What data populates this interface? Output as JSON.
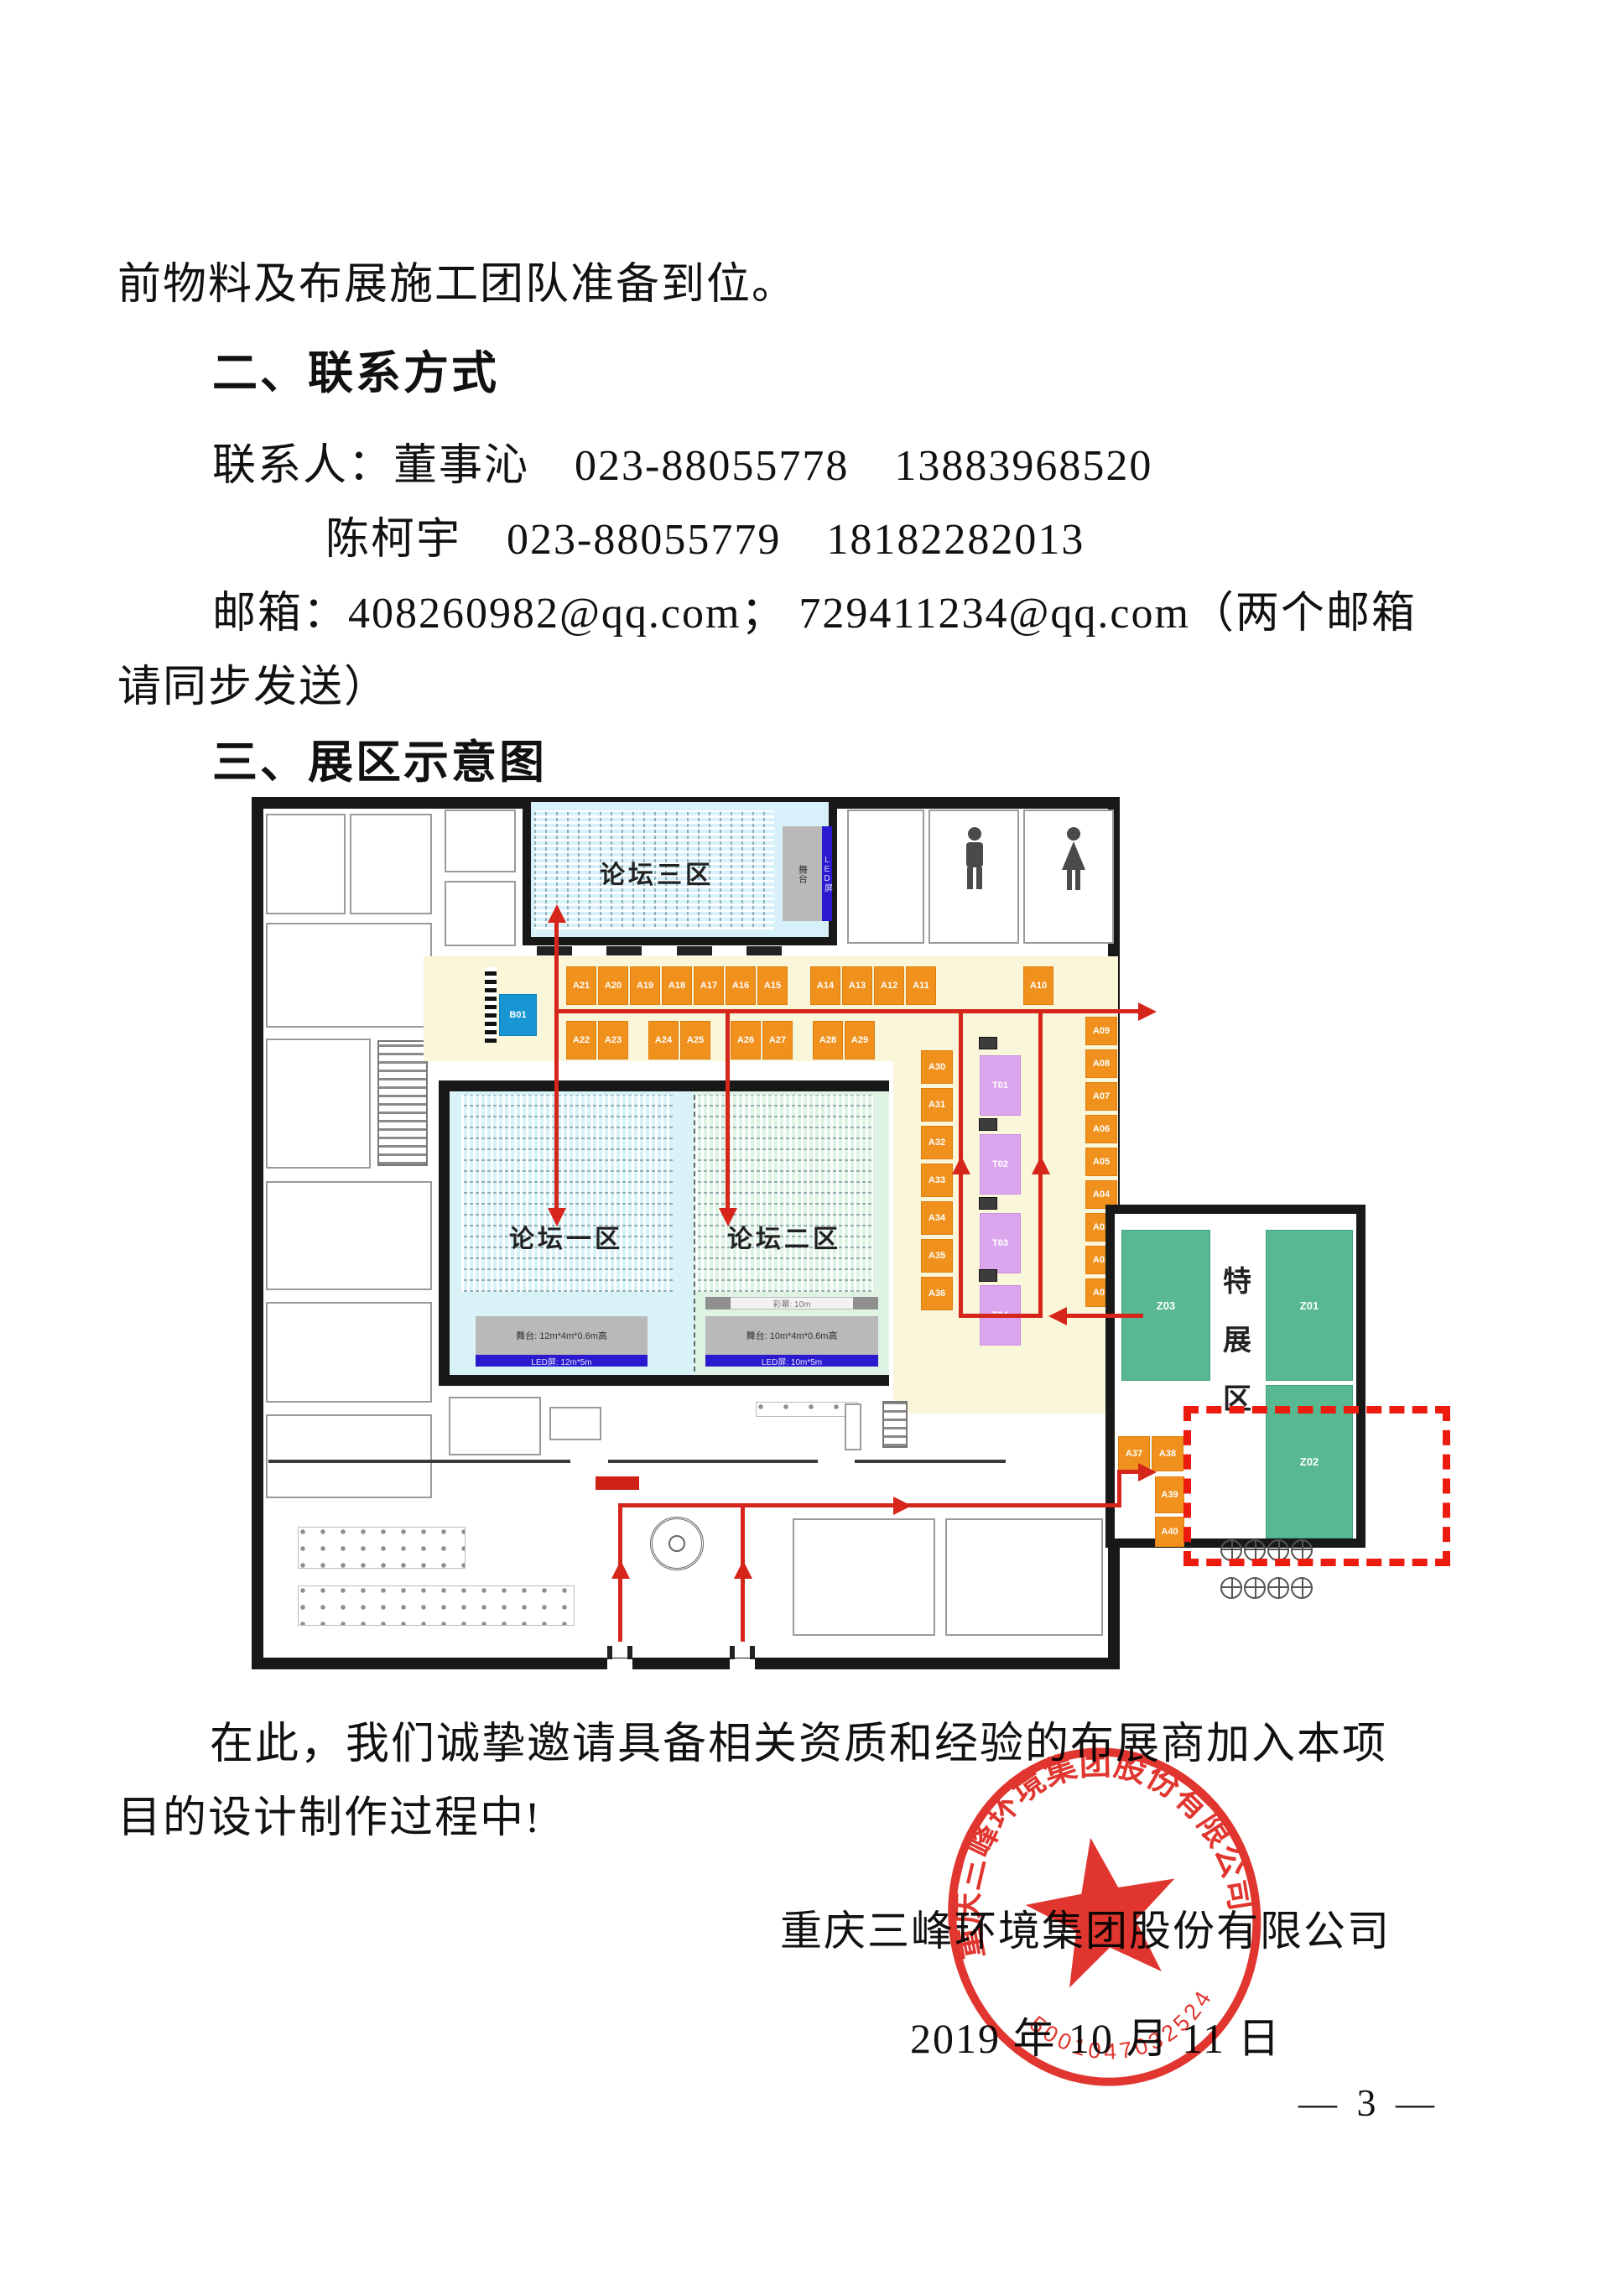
{
  "page": {
    "para_continuation": "前物料及布展施工团队准备到位。",
    "heading_contact": "二、联系方式",
    "contact_line1": "联系人：董事沁　023-88055778　13883968520",
    "contact_line2": "陈柯宇　023-88055779　18182282013",
    "email_line1": "邮箱：408260982@qq.com；  729411234@qq.com（两个邮箱",
    "email_line2": "请同步发送）",
    "heading_map": "三、展区示意图",
    "closing_line1": "在此，我们诚挚邀请具备相关资质和经验的布展商加入本项",
    "closing_line2": "目的设计制作过程中!"
  },
  "plan": {
    "rooms": {
      "forum1": "论坛一区",
      "forum2": "论坛二区",
      "forum3": "论坛三区",
      "special_zone": "特展区",
      "special_zone_chars": {
        "c1": "特",
        "c2": "展",
        "c3": "区"
      }
    },
    "booths": {
      "b01": "B01",
      "row1": [
        "A21",
        "A20",
        "A19",
        "A18",
        "A17",
        "A16",
        "A15",
        "A14",
        "A13",
        "A12",
        "A11",
        "A10"
      ],
      "row2": [
        "A22",
        "A23",
        "A24",
        "A25",
        "A26",
        "A27",
        "A28",
        "A29"
      ],
      "col_left": [
        "A30",
        "A31",
        "A32",
        "A33",
        "A34",
        "A35",
        "A36"
      ],
      "col_right": [
        "A09",
        "A08",
        "A07",
        "A06",
        "A05",
        "A04",
        "A03",
        "A02",
        "A01"
      ],
      "t_col": [
        "T01",
        "T02",
        "T03",
        "T04"
      ],
      "wing": [
        "A37",
        "A38",
        "A39",
        "A40"
      ],
      "z": [
        "Z03",
        "Z01",
        "Z02"
      ]
    },
    "stages": {
      "stage1": "舞台: 12m*4m*0.6m高",
      "led1": "LED屏: 12m*5m",
      "stage2": "舞台: 10m*4m*0.6m高",
      "led2": "LED屏: 10m*5m",
      "screen2": "彩幕: 10m",
      "stage3": "舞台",
      "led3": "LED屏"
    }
  },
  "icons": {
    "male_restroom": "male-restroom-icon",
    "female_restroom": "female-restroom-icon"
  },
  "footer": {
    "company": "重庆三峰环境集团股份有限公司",
    "date": "2019 年 10 月 11 日",
    "page_no": "— 3 —"
  },
  "seal": {
    "ring_text": "重庆三峰环境集团股份有限公司",
    "number": "5001047032524"
  },
  "colors": {
    "booth_orange": "#f0911d",
    "booth_purple": "#dba6ee",
    "booth_blue": "#1796d3",
    "booth_green": "#58b892",
    "room_cyan": "#d7f0fa",
    "room_green": "#def3e3",
    "corridor_cream": "#faf6d9",
    "path_red": "#d6251b",
    "seal_red": "#dd2018",
    "wall_black": "#181818"
  }
}
